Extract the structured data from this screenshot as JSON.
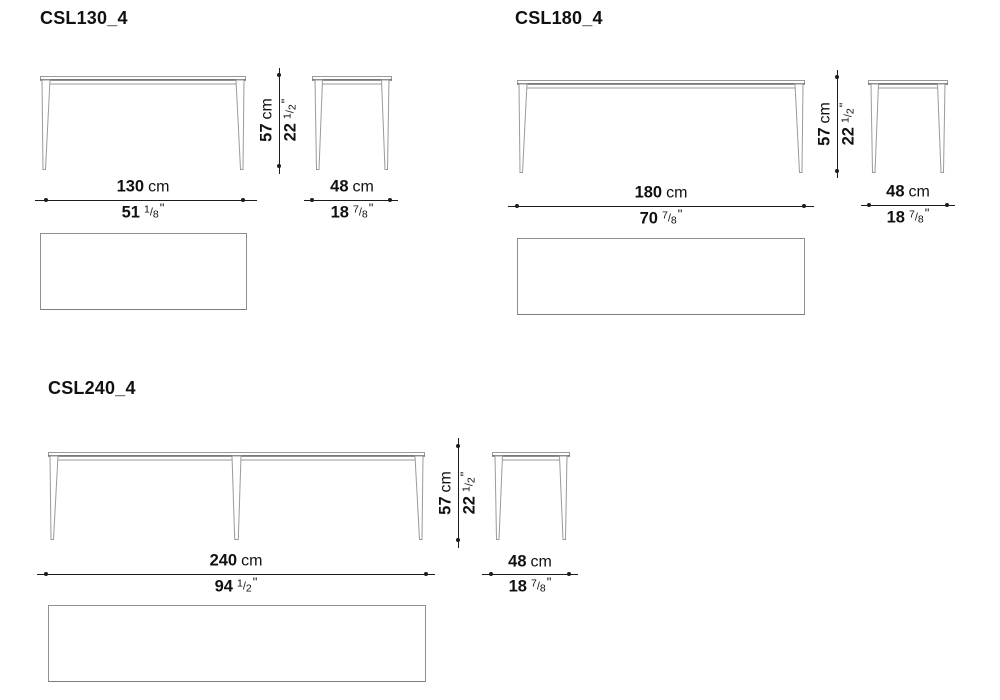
{
  "page": {
    "background": "#ffffff",
    "dimension_line_color": "#1c1c1c",
    "drawing_line_color": "#9a9a9a"
  },
  "products": [
    {
      "title": "CSL130_4",
      "width": {
        "cm": "130",
        "cm_unit": "cm",
        "inch": "51",
        "frac_num": "1",
        "frac_sep": "/",
        "frac_den": "8",
        "inch_mark": "\""
      },
      "depth": {
        "cm": "48",
        "cm_unit": "cm",
        "inch": "18",
        "frac_num": "7",
        "frac_sep": "/",
        "frac_den": "8",
        "inch_mark": "\""
      },
      "height": {
        "cm": "57",
        "cm_unit": "cm",
        "inch": "22",
        "frac_num": "1",
        "frac_sep": "/",
        "frac_den": "2",
        "inch_mark": "\""
      }
    },
    {
      "title": "CSL180_4",
      "width": {
        "cm": "180",
        "cm_unit": "cm",
        "inch": "70",
        "frac_num": "7",
        "frac_sep": "/",
        "frac_den": "8",
        "inch_mark": "\""
      },
      "depth": {
        "cm": "48",
        "cm_unit": "cm",
        "inch": "18",
        "frac_num": "7",
        "frac_sep": "/",
        "frac_den": "8",
        "inch_mark": "\""
      },
      "height": {
        "cm": "57",
        "cm_unit": "cm",
        "inch": "22",
        "frac_num": "1",
        "frac_sep": "/",
        "frac_den": "2",
        "inch_mark": "\""
      }
    },
    {
      "title": "CSL240_4",
      "width": {
        "cm": "240",
        "cm_unit": "cm",
        "inch": "94",
        "frac_num": "1",
        "frac_sep": "/",
        "frac_den": "2",
        "inch_mark": "\""
      },
      "depth": {
        "cm": "48",
        "cm_unit": "cm",
        "inch": "18",
        "frac_num": "7",
        "frac_sep": "/",
        "frac_den": "8",
        "inch_mark": "\""
      },
      "height": {
        "cm": "57",
        "cm_unit": "cm",
        "inch": "22",
        "frac_num": "1",
        "frac_sep": "/",
        "frac_den": "2",
        "inch_mark": "\""
      }
    }
  ]
}
